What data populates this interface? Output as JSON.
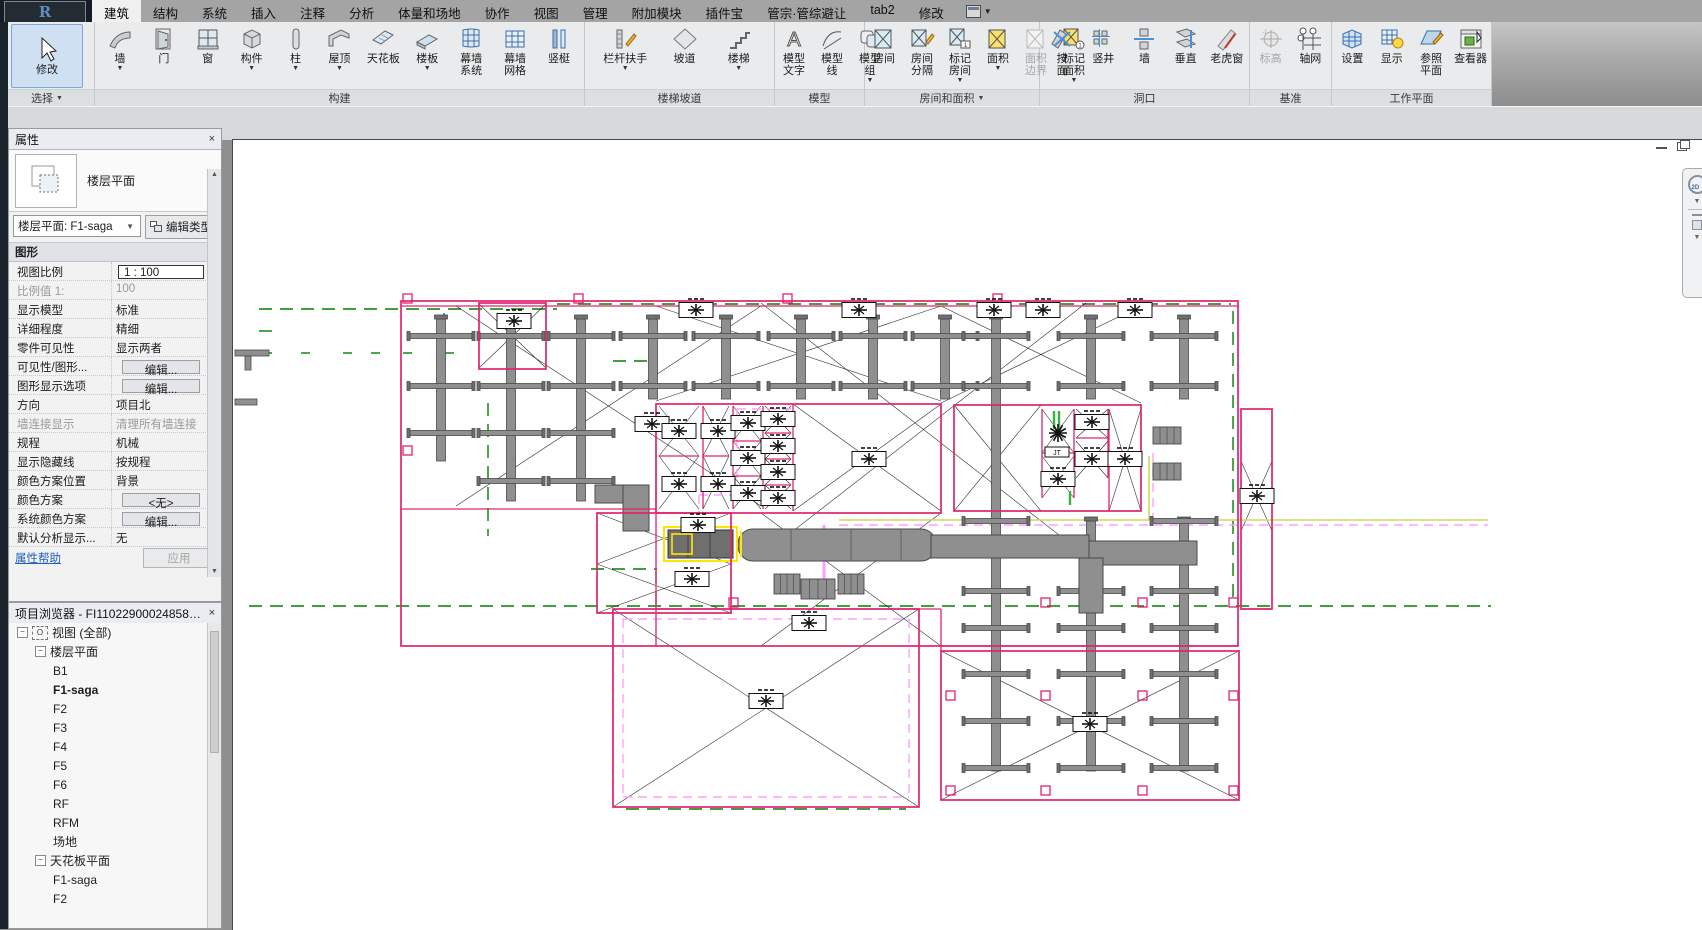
{
  "app": {
    "logo_letter": "R",
    "title_tabs_note": "Revit ribbon"
  },
  "tabs": {
    "items": [
      "建筑",
      "结构",
      "系统",
      "插入",
      "注释",
      "分析",
      "体量和场地",
      "协作",
      "视图",
      "管理",
      "附加模块",
      "插件宝",
      "管宗·管综避让",
      "tab2",
      "修改"
    ],
    "active_index": 0
  },
  "ribbon": {
    "panels": [
      {
        "name": "选择",
        "arrow": true,
        "width": 95,
        "items": [
          {
            "label": "修改",
            "icon": "cursor",
            "big": true
          }
        ]
      },
      {
        "name": "构建",
        "arrow": false,
        "width": 490,
        "items": [
          {
            "label": "墙",
            "icon": "wall",
            "dd": true
          },
          {
            "label": "门",
            "icon": "door"
          },
          {
            "label": "窗",
            "icon": "window"
          },
          {
            "label": "构件",
            "icon": "component",
            "dd": true
          },
          {
            "label": "柱",
            "icon": "column",
            "dd": true
          },
          {
            "label": "屋顶",
            "icon": "roof",
            "dd": true
          },
          {
            "label": "天花板",
            "icon": "ceiling"
          },
          {
            "label": "楼板",
            "icon": "floor",
            "dd": true
          },
          {
            "label": "幕墙",
            "label2": "系统",
            "icon": "curtain"
          },
          {
            "label": "幕墙",
            "label2": "网格",
            "icon": "curtaingrid"
          },
          {
            "label": "竖梃",
            "icon": "mullion"
          }
        ]
      },
      {
        "name": "楼梯坡道",
        "arrow": false,
        "width": 190,
        "items": [
          {
            "label": "栏杆扶手",
            "icon": "railing",
            "dd": true
          },
          {
            "label": "坡道",
            "icon": "ramp"
          },
          {
            "label": "楼梯",
            "icon": "stair",
            "dd": true
          }
        ]
      },
      {
        "name": "模型",
        "arrow": false,
        "width": 90,
        "items": [
          {
            "label": "模型",
            "label2": "文字",
            "icon": "mtext"
          },
          {
            "label": "模型",
            "label2": "线",
            "icon": "mline"
          },
          {
            "label": "模型",
            "label2": "组",
            "icon": "mgroup",
            "dd": true
          }
        ]
      },
      {
        "name": "房间和面积",
        "arrow": true,
        "width": 175,
        "items": [
          {
            "label": "房间",
            "icon": "room"
          },
          {
            "label": "房间",
            "label2": "分隔",
            "icon": "roomsep"
          },
          {
            "label": "标记",
            "label2": "房间",
            "icon": "tagroom",
            "dd": true
          },
          {
            "label": "面积",
            "icon": "area",
            "dd": true
          },
          {
            "label": "面积",
            "label2": "边界",
            "icon": "areab",
            "disabled": true
          },
          {
            "label": "标记",
            "label2": "面积",
            "icon": "tagarea",
            "dd": true
          }
        ]
      },
      {
        "name": "洞口",
        "arrow": false,
        "width": 210,
        "items": [
          {
            "label": "按",
            "label2": "面",
            "icon": "byface"
          },
          {
            "label": "竖井",
            "icon": "shaft"
          },
          {
            "label": "墙",
            "icon": "wallop"
          },
          {
            "label": "垂直",
            "icon": "vertical"
          },
          {
            "label": "老虎窗",
            "icon": "dormer"
          }
        ]
      },
      {
        "name": "基准",
        "arrow": false,
        "width": 82,
        "items": [
          {
            "label": "标高",
            "icon": "level",
            "disabled": true
          },
          {
            "label": "轴网",
            "icon": "grid"
          }
        ]
      },
      {
        "name": "工作平面",
        "arrow": false,
        "width": 160,
        "items": [
          {
            "label": "设置",
            "icon": "wpset"
          },
          {
            "label": "显示",
            "icon": "wpshow"
          },
          {
            "label": "参照",
            "label2": "平面",
            "icon": "refplane"
          },
          {
            "label": "查看器",
            "icon": "viewer"
          }
        ]
      }
    ]
  },
  "properties": {
    "title": "属性",
    "close": "×",
    "preview_label": "楼层平面",
    "type_selector": "楼层平面: F1-saga",
    "edit_type": "编辑类型",
    "section": "图形",
    "rows": [
      {
        "label": "视图比例",
        "value": "1 : 100",
        "kind": "input"
      },
      {
        "label": "比例值 1:",
        "value": "100",
        "kind": "gray"
      },
      {
        "label": "显示模型",
        "value": "标准",
        "kind": "text"
      },
      {
        "label": "详细程度",
        "value": "精细",
        "kind": "text"
      },
      {
        "label": "零件可见性",
        "value": "显示两者",
        "kind": "text"
      },
      {
        "label": "可见性/图形...",
        "value": "编辑...",
        "kind": "button"
      },
      {
        "label": "图形显示选项",
        "value": "编辑...",
        "kind": "button"
      },
      {
        "label": "方向",
        "value": "项目北",
        "kind": "text"
      },
      {
        "label": "墙连接显示",
        "value": "清理所有墙连接",
        "kind": "gray"
      },
      {
        "label": "规程",
        "value": "机械",
        "kind": "text"
      },
      {
        "label": "显示隐藏线",
        "value": "按规程",
        "kind": "text"
      },
      {
        "label": "颜色方案位置",
        "value": "背景",
        "kind": "text"
      },
      {
        "label": "颜色方案",
        "value": "<无>",
        "kind": "button"
      },
      {
        "label": "系统颜色方案",
        "value": "编辑...",
        "kind": "button"
      },
      {
        "label": "默认分析显示...",
        "value": "无",
        "kind": "text"
      }
    ],
    "help_link": "属性帮助",
    "apply": "应用"
  },
  "browser": {
    "title": "项目浏览器 - FI110229000248580ef...",
    "close": "×",
    "tree": [
      {
        "label": "视图 (全部)",
        "lvl": 0,
        "exp": true,
        "vic": true
      },
      {
        "label": "楼层平面",
        "lvl": 1,
        "exp": true
      },
      {
        "label": "B1",
        "lvl": 2
      },
      {
        "label": "F1-saga",
        "lvl": 2,
        "bold": true
      },
      {
        "label": "F2",
        "lvl": 2
      },
      {
        "label": "F3",
        "lvl": 2
      },
      {
        "label": "F4",
        "lvl": 2
      },
      {
        "label": "F5",
        "lvl": 2
      },
      {
        "label": "F6",
        "lvl": 2
      },
      {
        "label": "RF",
        "lvl": 2
      },
      {
        "label": "RFM",
        "lvl": 2
      },
      {
        "label": "场地",
        "lvl": 2
      },
      {
        "label": "天花板平面",
        "lvl": 1,
        "exp": true
      },
      {
        "label": "F1-saga",
        "lvl": 2
      },
      {
        "label": "F2",
        "lvl": 2
      }
    ]
  },
  "canvas_labels": {
    "jt_box": "JT"
  },
  "colors": {
    "boundary_pink": "#e0246e",
    "duct_fill": "#8f8f8f",
    "duct_edge": "#4a4a4a",
    "duct_dark": "#707070",
    "green_dash": "#008000",
    "violet": "#ff9fff",
    "yellow_green": "#c9da5e",
    "selection_yellow": "#ffe600",
    "xline": "#1a1a1a",
    "bright_green": "#3bb143"
  },
  "plan": {
    "outline_rects": [
      [
        400,
        300,
        837,
        345
      ],
      [
        478,
        302,
        67,
        66
      ],
      [
        655,
        403,
        285,
        109
      ],
      [
        953,
        404,
        187,
        106
      ],
      [
        940,
        650,
        298,
        149
      ],
      [
        612,
        608,
        306,
        198
      ],
      [
        596,
        512,
        134,
        100
      ],
      [
        1240,
        408,
        31,
        200
      ]
    ],
    "wall_lines": [
      [
        400,
        305,
        1237,
        305
      ],
      [
        400,
        508,
        655,
        508
      ],
      [
        655,
        508,
        655,
        645
      ],
      [
        940,
        608,
        940,
        650
      ],
      [
        655,
        608,
        940,
        608
      ],
      [
        940,
        645,
        1237,
        645
      ],
      [
        1041,
        408,
        1041,
        497
      ],
      [
        1073,
        408,
        1073,
        497
      ],
      [
        1107,
        408,
        1107,
        477
      ],
      [
        1041,
        452,
        1073,
        452
      ],
      [
        1075,
        437,
        1107,
        437
      ],
      [
        1108,
        408,
        1108,
        510
      ],
      [
        702,
        405,
        702,
        508
      ],
      [
        732,
        405,
        732,
        508
      ],
      [
        762,
        405,
        762,
        508
      ],
      [
        792,
        403,
        792,
        510
      ],
      [
        658,
        455,
        698,
        455
      ],
      [
        702,
        455,
        728,
        455
      ],
      [
        732,
        440,
        760,
        440
      ],
      [
        732,
        475,
        760,
        475
      ],
      [
        764,
        432,
        790,
        432
      ],
      [
        764,
        458,
        790,
        458
      ],
      [
        764,
        484,
        790,
        484
      ],
      [
        1240,
        608,
        1271,
        608
      ]
    ],
    "pink_squares": [
      [
        1040,
        597
      ],
      [
        1137,
        597
      ],
      [
        1228,
        597
      ],
      [
        945,
        690
      ],
      [
        1040,
        690
      ],
      [
        1137,
        690
      ],
      [
        1228,
        690
      ],
      [
        945,
        785
      ],
      [
        1040,
        785
      ],
      [
        1137,
        785
      ],
      [
        1228,
        785
      ],
      [
        728,
        597
      ],
      [
        402,
        293
      ],
      [
        573,
        293
      ],
      [
        782,
        293
      ],
      [
        992,
        293
      ],
      [
        402,
        445
      ]
    ],
    "x_regions": [
      [
        478,
        303,
        545,
        367
      ],
      [
        455,
        305,
        760,
        505
      ],
      [
        655,
        305,
        940,
        400
      ],
      [
        940,
        305,
        1140,
        402
      ],
      [
        760,
        302,
        1085,
        555
      ],
      [
        596,
        512,
        730,
        563
      ],
      [
        596,
        563,
        730,
        612
      ],
      [
        760,
        512,
        940,
        645
      ],
      [
        612,
        608,
        918,
        806
      ],
      [
        940,
        650,
        1238,
        799
      ],
      [
        953,
        404,
        1040,
        510
      ],
      [
        1041,
        408,
        1073,
        452
      ],
      [
        1075,
        408,
        1107,
        437
      ],
      [
        1075,
        440,
        1107,
        477
      ],
      [
        1041,
        455,
        1073,
        497
      ],
      [
        1108,
        408,
        1140,
        510
      ],
      [
        1240,
        460,
        1271,
        530
      ],
      [
        658,
        405,
        698,
        455
      ],
      [
        658,
        455,
        698,
        508
      ],
      [
        702,
        405,
        728,
        455
      ],
      [
        702,
        455,
        728,
        508
      ],
      [
        732,
        405,
        760,
        440
      ],
      [
        732,
        440,
        760,
        475
      ],
      [
        732,
        475,
        760,
        508
      ],
      [
        764,
        405,
        790,
        432
      ],
      [
        764,
        432,
        790,
        458
      ],
      [
        764,
        458,
        790,
        484
      ],
      [
        764,
        484,
        790,
        508
      ],
      [
        792,
        403,
        940,
        510
      ]
    ],
    "trunks": [
      {
        "x": 440,
        "y1": 318,
        "y2": 460,
        "arms": [
          335,
          385,
          432
        ]
      },
      {
        "x": 510,
        "y1": 318,
        "y2": 500,
        "arms": [
          335,
          385,
          432,
          480
        ]
      },
      {
        "x": 580,
        "y1": 318,
        "y2": 500,
        "arms": [
          335,
          385,
          432,
          480
        ]
      },
      {
        "x": 652,
        "y1": 318,
        "y2": 398,
        "arms": [
          335,
          385
        ]
      },
      {
        "x": 725,
        "y1": 318,
        "y2": 398,
        "arms": [
          335,
          385
        ]
      },
      {
        "x": 800,
        "y1": 318,
        "y2": 398,
        "arms": [
          335,
          385
        ]
      },
      {
        "x": 872,
        "y1": 318,
        "y2": 398,
        "arms": [
          335,
          385
        ]
      },
      {
        "x": 944,
        "y1": 318,
        "y2": 398,
        "arms": [
          335,
          385
        ]
      },
      {
        "x": 995,
        "y1": 318,
        "y2": 770,
        "arms": [
          335,
          385,
          520,
          590,
          627,
          673,
          720,
          767
        ]
      },
      {
        "x": 1090,
        "y1": 318,
        "y2": 398,
        "arms": [
          335,
          385
        ]
      },
      {
        "x": 1090,
        "y1": 520,
        "y2": 770,
        "arms": [
          590,
          627,
          673,
          720,
          767
        ]
      },
      {
        "x": 1183,
        "y1": 318,
        "y2": 398,
        "arms": [
          335,
          385
        ]
      },
      {
        "x": 1183,
        "y1": 520,
        "y2": 770,
        "arms": [
          520,
          590,
          627,
          673,
          720,
          767
        ]
      }
    ],
    "terminals": [
      [
        513,
        320
      ],
      [
        695,
        309
      ],
      [
        858,
        309
      ],
      [
        993,
        309
      ],
      [
        1042,
        309
      ],
      [
        1134,
        309
      ],
      [
        651,
        423
      ],
      [
        678,
        430
      ],
      [
        678,
        483
      ],
      [
        717,
        430
      ],
      [
        717,
        483
      ],
      [
        747,
        422
      ],
      [
        747,
        457
      ],
      [
        747,
        492
      ],
      [
        777,
        418
      ],
      [
        777,
        445
      ],
      [
        777,
        471
      ],
      [
        777,
        497
      ],
      [
        868,
        458
      ],
      [
        1091,
        421
      ],
      [
        1091,
        458
      ],
      [
        1057,
        478
      ],
      [
        1124,
        458
      ],
      [
        1256,
        495
      ],
      [
        697,
        524
      ],
      [
        691,
        578
      ],
      [
        808,
        622
      ],
      [
        765,
        700
      ],
      [
        1089,
        723
      ]
    ],
    "green_lines": [
      [
        258,
        308,
        556,
        308
      ],
      [
        556,
        303,
        1230,
        303
      ],
      [
        258,
        330,
        272,
        330
      ],
      [
        443,
        312,
        443,
        448
      ],
      [
        487,
        402,
        487,
        535
      ],
      [
        612,
        360,
        648,
        360
      ],
      [
        248,
        605,
        1490,
        605
      ],
      [
        590,
        568,
        656,
        568
      ],
      [
        655,
        570,
        655,
        612
      ],
      [
        1232,
        310,
        1232,
        600
      ],
      [
        625,
        808,
        905,
        808
      ]
    ],
    "green_ticks_y": 352,
    "green_ticks_x": [
      262,
      300,
      342,
      370,
      402,
      444
    ],
    "violet_dash": [
      [
        838,
        524,
        1487,
        524
      ],
      [
        622,
        618,
        908,
        618
      ],
      [
        622,
        618,
        622,
        796
      ],
      [
        622,
        796,
        908,
        796
      ],
      [
        908,
        618,
        908,
        796
      ],
      [
        1152,
        452,
        1152,
        524
      ],
      [
        736,
        408,
        736,
        502
      ],
      [
        736,
        408,
        792,
        408
      ],
      [
        698,
        494,
        698,
        514
      ],
      [
        698,
        494,
        755,
        494
      ]
    ],
    "violet_solid": [
      [
        823,
        524,
        823,
        578
      ]
    ],
    "yg_lines": [
      [
        838,
        519,
        1487,
        519
      ],
      [
        1148,
        455,
        1148,
        519
      ]
    ],
    "green_marks": [
      [
        1053,
        410,
        1053,
        428
      ],
      [
        1058,
        410,
        1058,
        428
      ],
      [
        1069,
        490,
        1069,
        504
      ]
    ],
    "fans": [
      [
        1152,
        426,
        28,
        17
      ],
      [
        1152,
        462,
        28,
        17
      ],
      [
        773,
        573,
        26,
        20
      ],
      [
        837,
        573,
        26,
        20
      ],
      [
        800,
        578,
        34,
        20
      ]
    ],
    "stubs": [
      [
        234,
        349,
        34,
        6
      ],
      [
        234,
        398,
        22,
        6
      ],
      [
        244,
        355,
        6,
        14
      ]
    ],
    "main_duct": {
      "oval": [
        737,
        528,
        198,
        32
      ],
      "mid": [
        930,
        534,
        158,
        23
      ],
      "right": [
        1088,
        540,
        108,
        24
      ],
      "elbow_down": [
        1078,
        557,
        24,
        55
      ],
      "ahu": [
        667,
        529,
        65,
        28
      ],
      "sel": [
        663,
        526,
        73,
        34
      ],
      "elbow1": [
        594,
        484,
        50,
        18
      ],
      "elbow2": [
        622,
        484,
        26,
        46
      ],
      "seams": [
        790,
        850,
        900
      ]
    },
    "jt_box": [
      1044,
      446,
      24,
      10
    ],
    "starburst": [
      1057,
      432
    ]
  }
}
